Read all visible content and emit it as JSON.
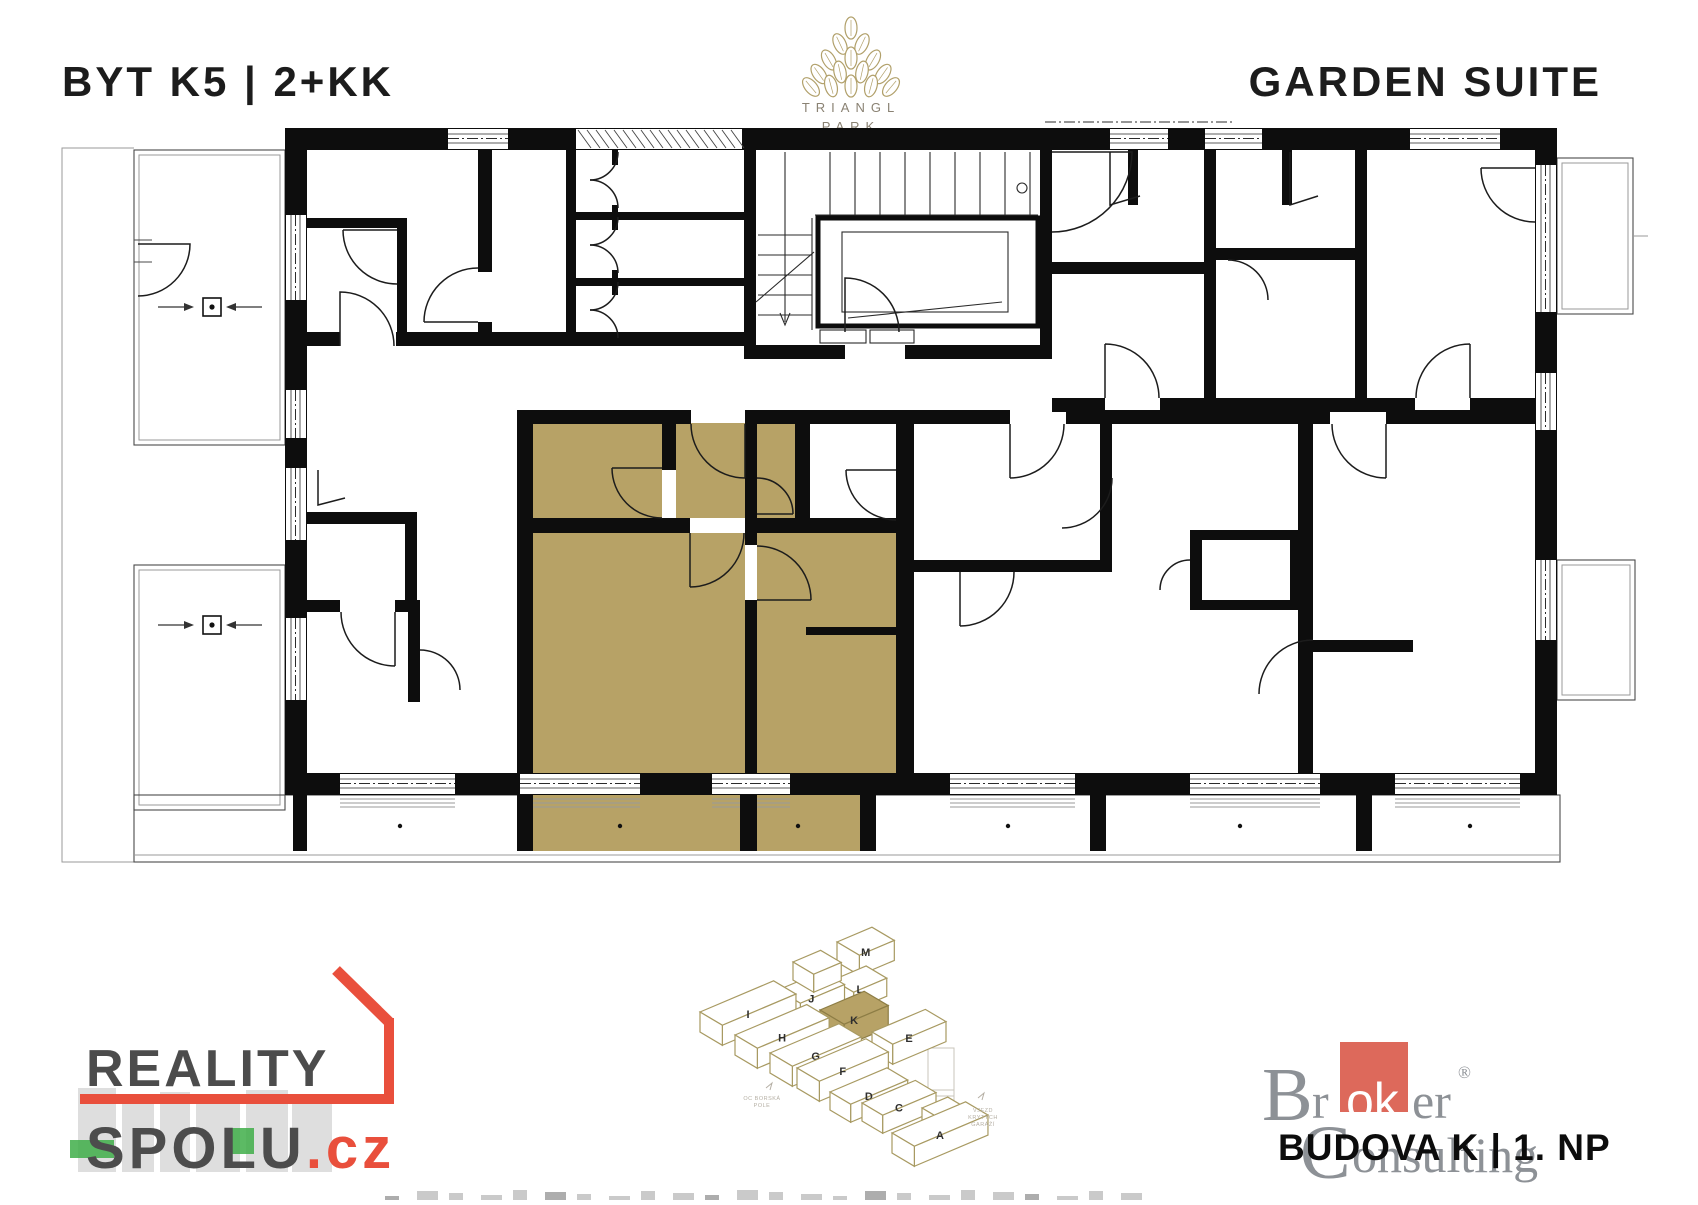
{
  "header": {
    "unit_title": "BYT K5 | 2+KK",
    "suite_title": "GARDEN SUITE"
  },
  "brand": {
    "line1": "TRIANGL",
    "line2": "PARK",
    "leaf_color": "#b1a06a",
    "text_color": "#8a8273"
  },
  "floorplan": {
    "highlighted_unit": "BYT K5",
    "highlight_color": "#b7a266",
    "wall_color": "#0d0d0d"
  },
  "site_map": {
    "highlighted_building": "K",
    "outline_color": "#a89a62",
    "highlight_fill": "#b7a266",
    "label_color": "#2f2f2f",
    "note_left": {
      "line1": "OC BORSKÁ",
      "line2": "POLE"
    },
    "note_right": {
      "line1": "VJEZD",
      "line2": "KRYTÝCH",
      "line3": "GARÁŽÍ"
    },
    "buildings": [
      {
        "label": "M",
        "x": 837,
        "y": 942,
        "l": 38,
        "w": 26,
        "h": 20,
        "highlight": false
      },
      {
        "label": "L",
        "x": 833,
        "y": 980,
        "l": 36,
        "w": 24,
        "h": 18,
        "highlight": false
      },
      {
        "label": "J",
        "x": 778,
        "y": 990,
        "l": 48,
        "w": 26,
        "h": 20,
        "highlight": false
      },
      {
        "label": "",
        "x": 793,
        "y": 962,
        "l": 30,
        "w": 24,
        "h": 18,
        "highlight": false
      },
      {
        "label": "I",
        "x": 700,
        "y": 1012,
        "l": 80,
        "w": 26,
        "h": 20,
        "highlight": false
      },
      {
        "label": "K",
        "x": 820,
        "y": 1010,
        "l": 48,
        "w": 28,
        "h": 22,
        "highlight": true
      },
      {
        "label": "E",
        "x": 872,
        "y": 1032,
        "l": 58,
        "w": 24,
        "h": 20,
        "highlight": false
      },
      {
        "label": "H",
        "x": 735,
        "y": 1035,
        "l": 78,
        "w": 26,
        "h": 20,
        "highlight": false
      },
      {
        "label": "G",
        "x": 770,
        "y": 1053,
        "l": 75,
        "w": 26,
        "h": 20,
        "highlight": false
      },
      {
        "label": "F",
        "x": 797,
        "y": 1068,
        "l": 75,
        "w": 26,
        "h": 20,
        "highlight": false
      },
      {
        "label": "D",
        "x": 830,
        "y": 1092,
        "l": 62,
        "w": 24,
        "h": 18,
        "highlight": false
      },
      {
        "label": "C",
        "x": 862,
        "y": 1103,
        "l": 58,
        "w": 24,
        "h": 18,
        "highlight": false
      },
      {
        "label": "B",
        "x": 922,
        "y": 1108,
        "l": 28,
        "w": 22,
        "h": 16,
        "highlight": false
      },
      {
        "label": "A",
        "x": 892,
        "y": 1133,
        "l": 80,
        "w": 26,
        "h": 20,
        "highlight": false
      }
    ]
  },
  "footer": {
    "reality": {
      "word1": "REALITY",
      "word2": "SPOLU",
      "tld": ".cz",
      "text_color": "#4c4c4c",
      "accent_color": "#e94f3c",
      "green_color": "#3fae49"
    },
    "broker": {
      "b": "B",
      "roker_pre": "r",
      "roker_white": "ok",
      "roker_post": "er",
      "reg": "®",
      "c": "C",
      "onsulting": "onsulting",
      "square_color": "#dd695b",
      "text_color": "#8d9196"
    },
    "building_floor": "BUDOVA K | 1. NP"
  }
}
